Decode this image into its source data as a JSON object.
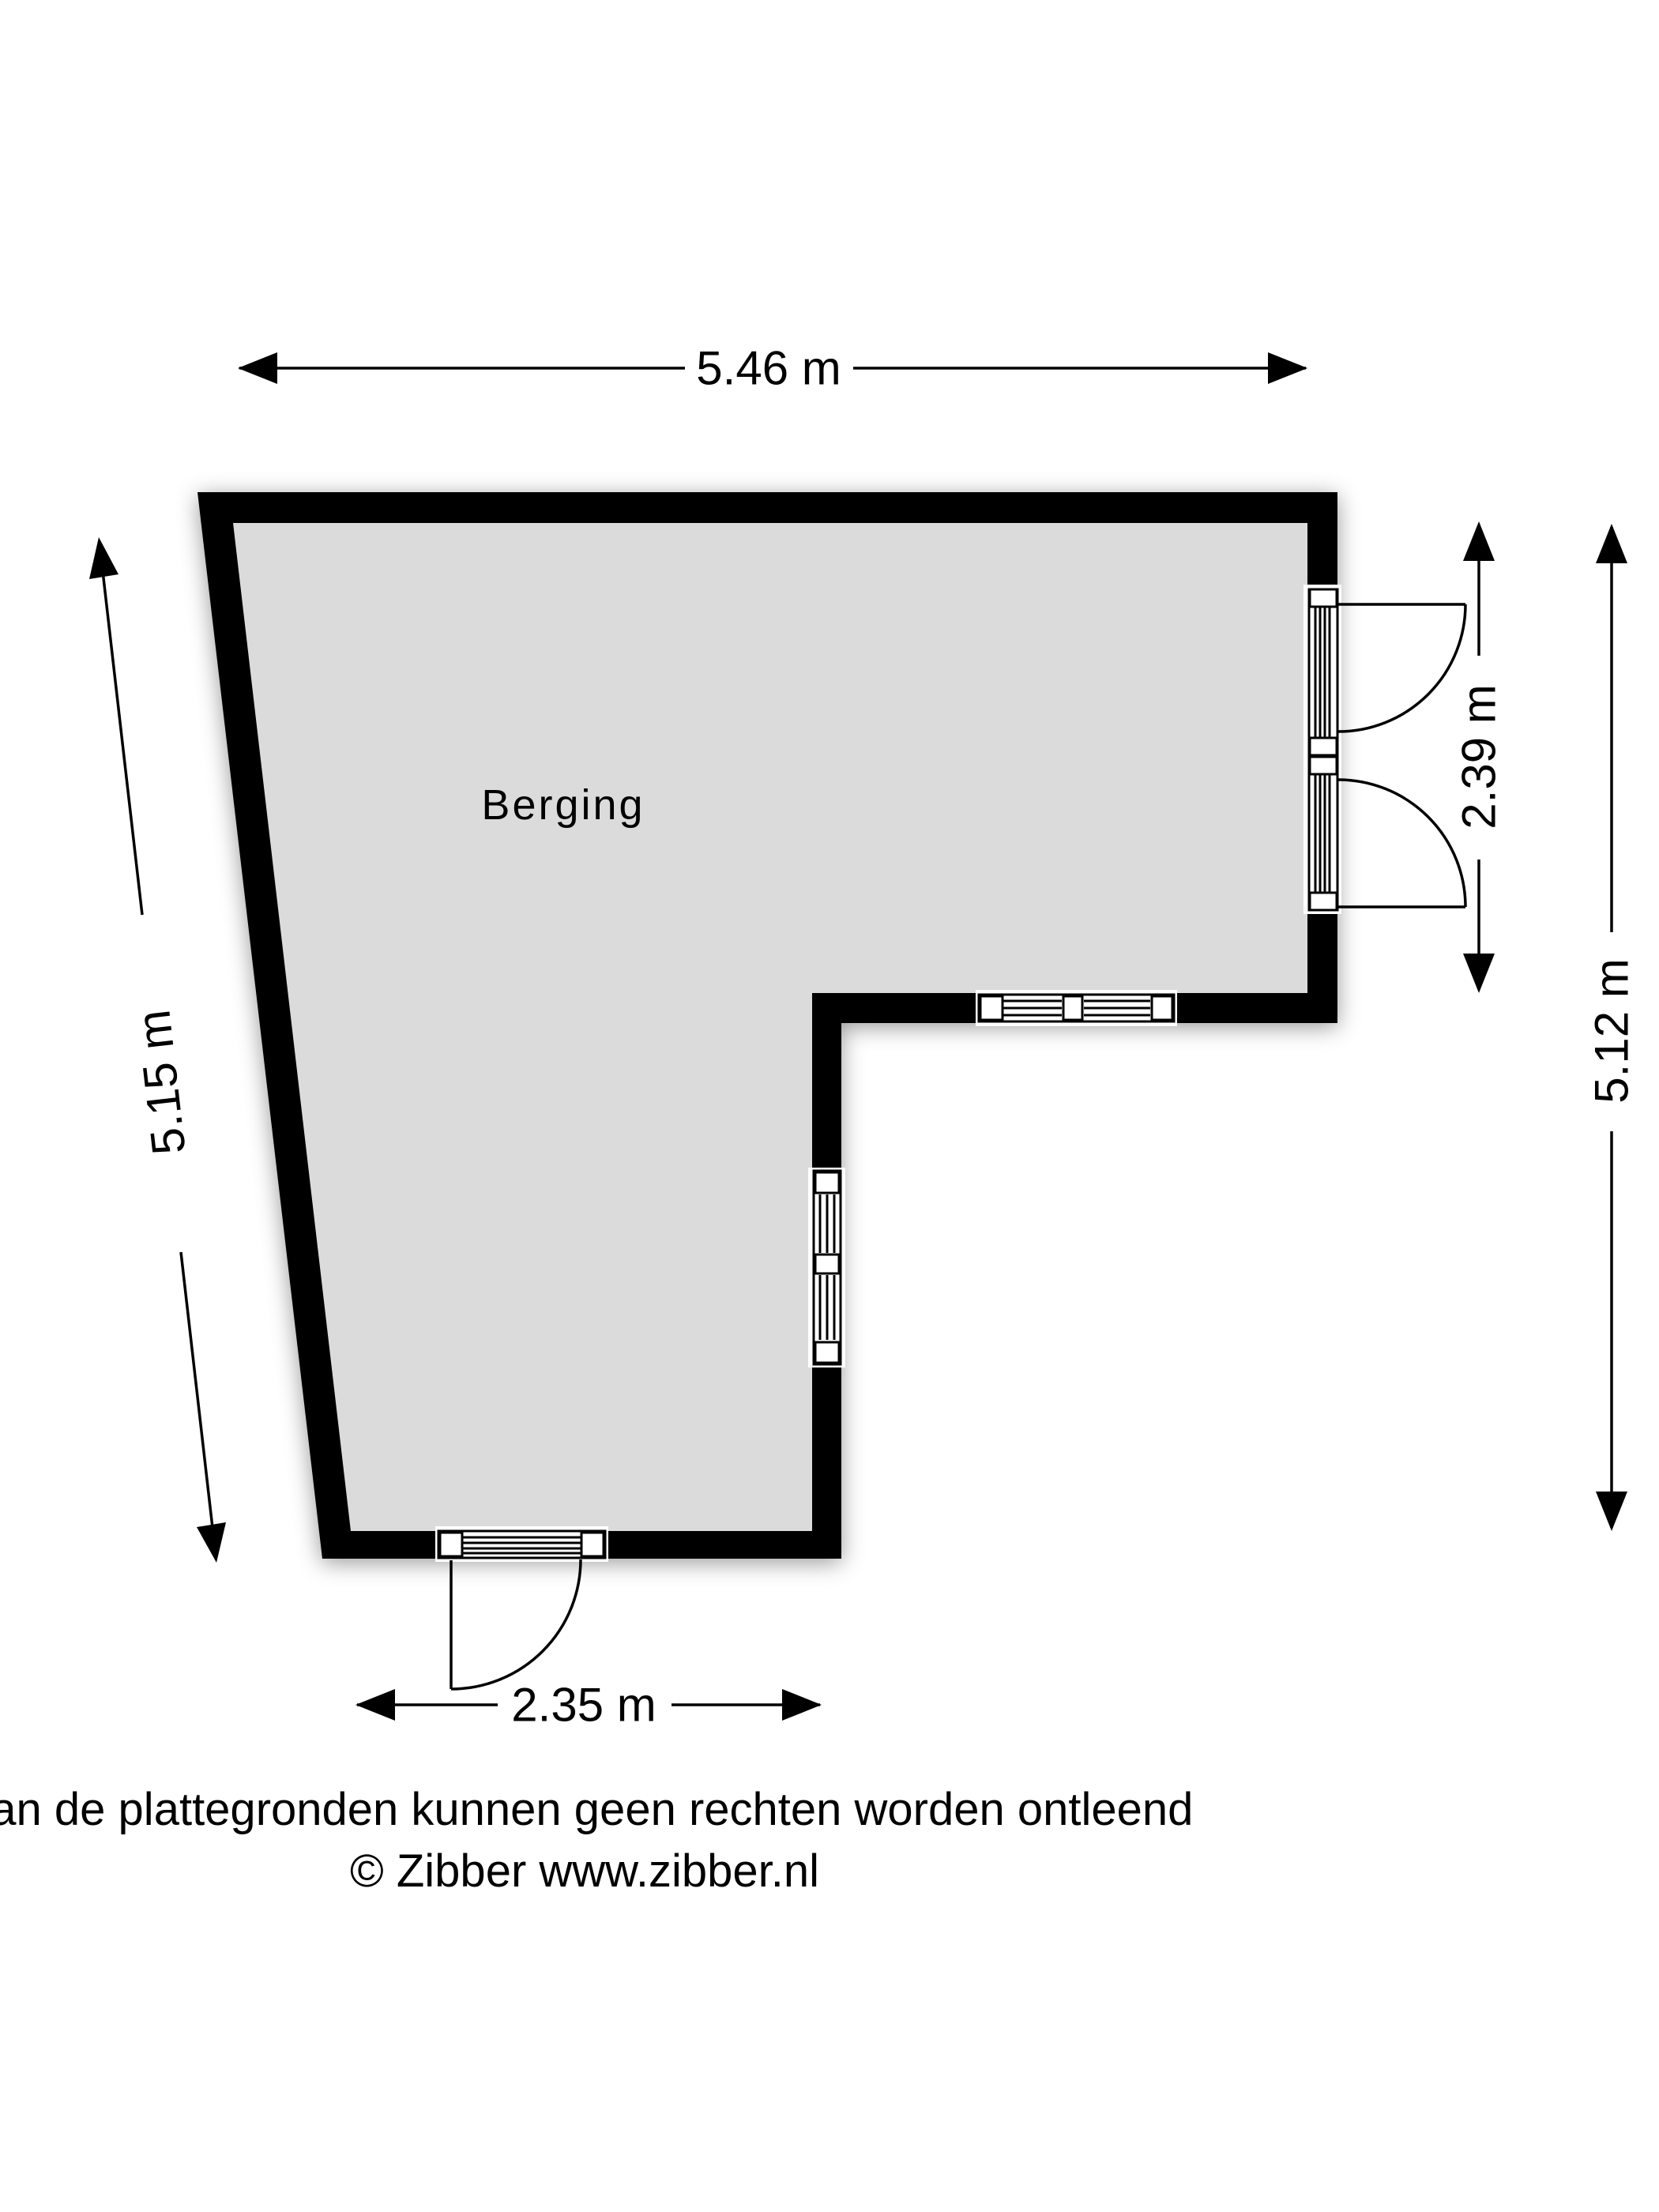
{
  "floorplan": {
    "room": {
      "label": "Berging"
    },
    "dimensions": {
      "top": {
        "label": "5.46 m"
      },
      "left": {
        "label": "5.15 m"
      },
      "right_inner": {
        "label": "2.39 m"
      },
      "right_outer": {
        "label": "5.12 m"
      },
      "bottom": {
        "label": "2.35 m"
      }
    },
    "footer": {
      "disclaimer": "Aan de plattegronden kunnen geen rechten worden ontleend",
      "copyright": "© Zibber www.zibber.nl"
    },
    "colors": {
      "wall": "#000000",
      "floor": "#dbdbdb",
      "background": "#ffffff"
    }
  }
}
